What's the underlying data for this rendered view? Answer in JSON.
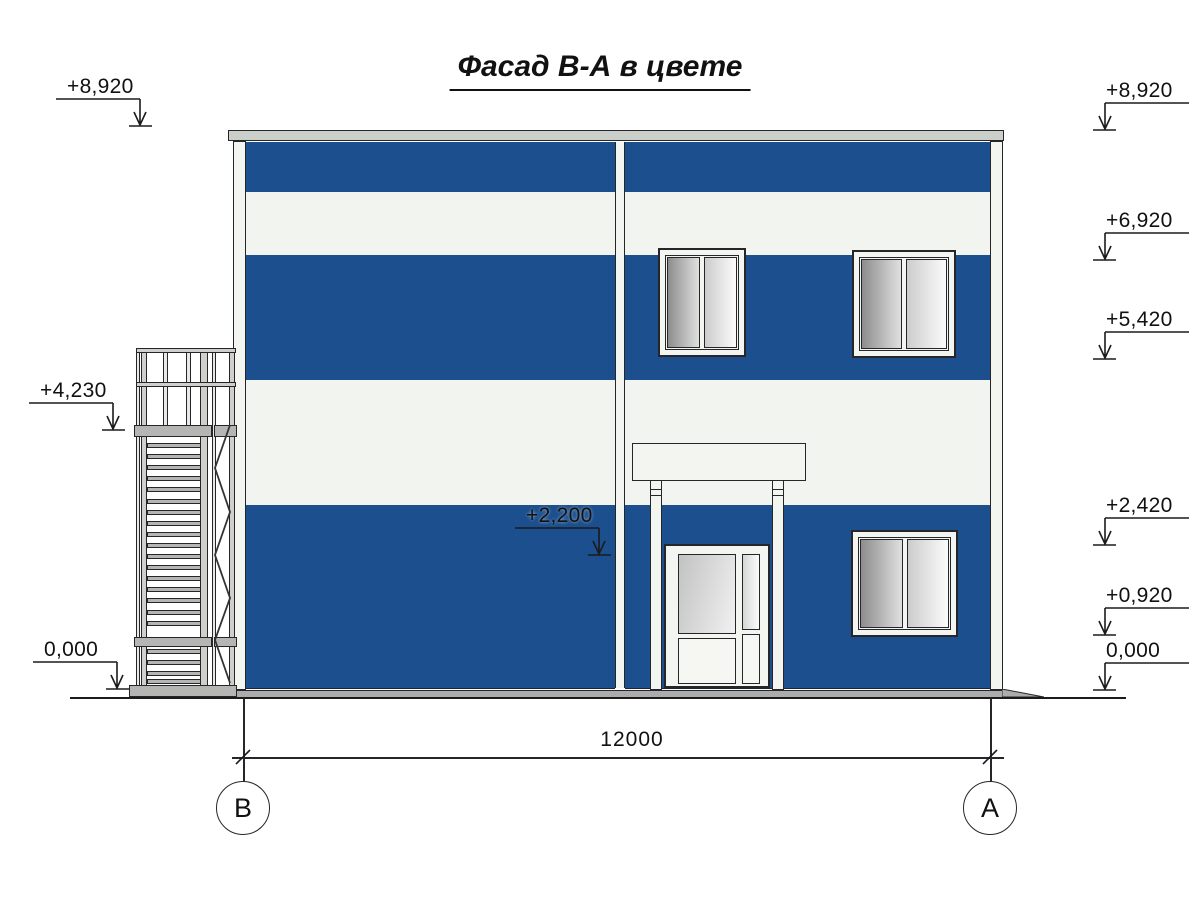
{
  "title": "Фасад В-А в цвете",
  "colors": {
    "facadeBlue": "#1b4f8d",
    "facadeWhite": "#f2f4ef",
    "frameWhite": "#f3f5f0",
    "metalGray": "#b5b5b3",
    "roofGray": "#cbcfca",
    "plinthGray": "#acacac"
  },
  "markers": {
    "left": [
      {
        "label": "+8,920"
      },
      {
        "label": "+4,230"
      },
      {
        "label": "0,000"
      }
    ],
    "right": [
      {
        "label": "+8,920"
      },
      {
        "label": "+6,920"
      },
      {
        "label": "+5,420"
      },
      {
        "label": "+2,420"
      },
      {
        "label": "+0,920"
      },
      {
        "label": "0,000"
      }
    ],
    "inner": [
      {
        "label": "+2,200"
      }
    ]
  },
  "dimension": {
    "value": "12000"
  },
  "axes": [
    {
      "label": "В"
    },
    {
      "label": "А"
    }
  ]
}
